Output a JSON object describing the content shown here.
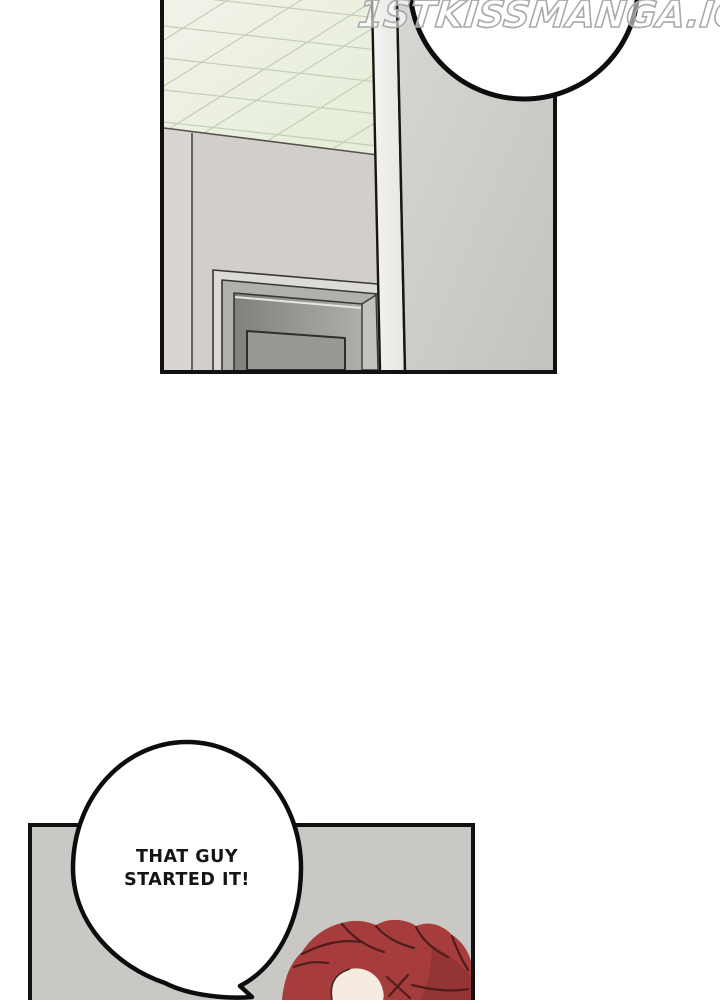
{
  "watermark": {
    "text": "1STKISSMANGA.IO"
  },
  "page": {
    "background": "#ffffff",
    "ink": "#111111"
  },
  "panel_top": {
    "name": "hallway-door-scene",
    "colors": {
      "ceiling_tiles": "#ebf0df",
      "ceiling_grid": "#c6cdb6",
      "left_wall": "#d2cfcb",
      "left_wall_edge": "#d9d6d2",
      "right_wall": "#c9c8c4",
      "pillar": "#f2f1ed",
      "door_frame_light": "#dddbd6",
      "door_frame_mid": "#b2b0ac",
      "door_frame_dark": "#868480",
      "door_inner": "#9a9894"
    }
  },
  "bubble_top": {
    "text": ""
  },
  "panel_bottom": {
    "name": "red-haired-character-scene",
    "colors": {
      "background": "#c9c8c4",
      "hair": "#a63c3b",
      "hair_shadow": "#8c2f31",
      "hair_line": "#4f1d1d",
      "skin": "#f5ebe1"
    }
  },
  "bubble_bottom": {
    "line1": "THAT GUY",
    "line2": "STARTED IT!"
  }
}
